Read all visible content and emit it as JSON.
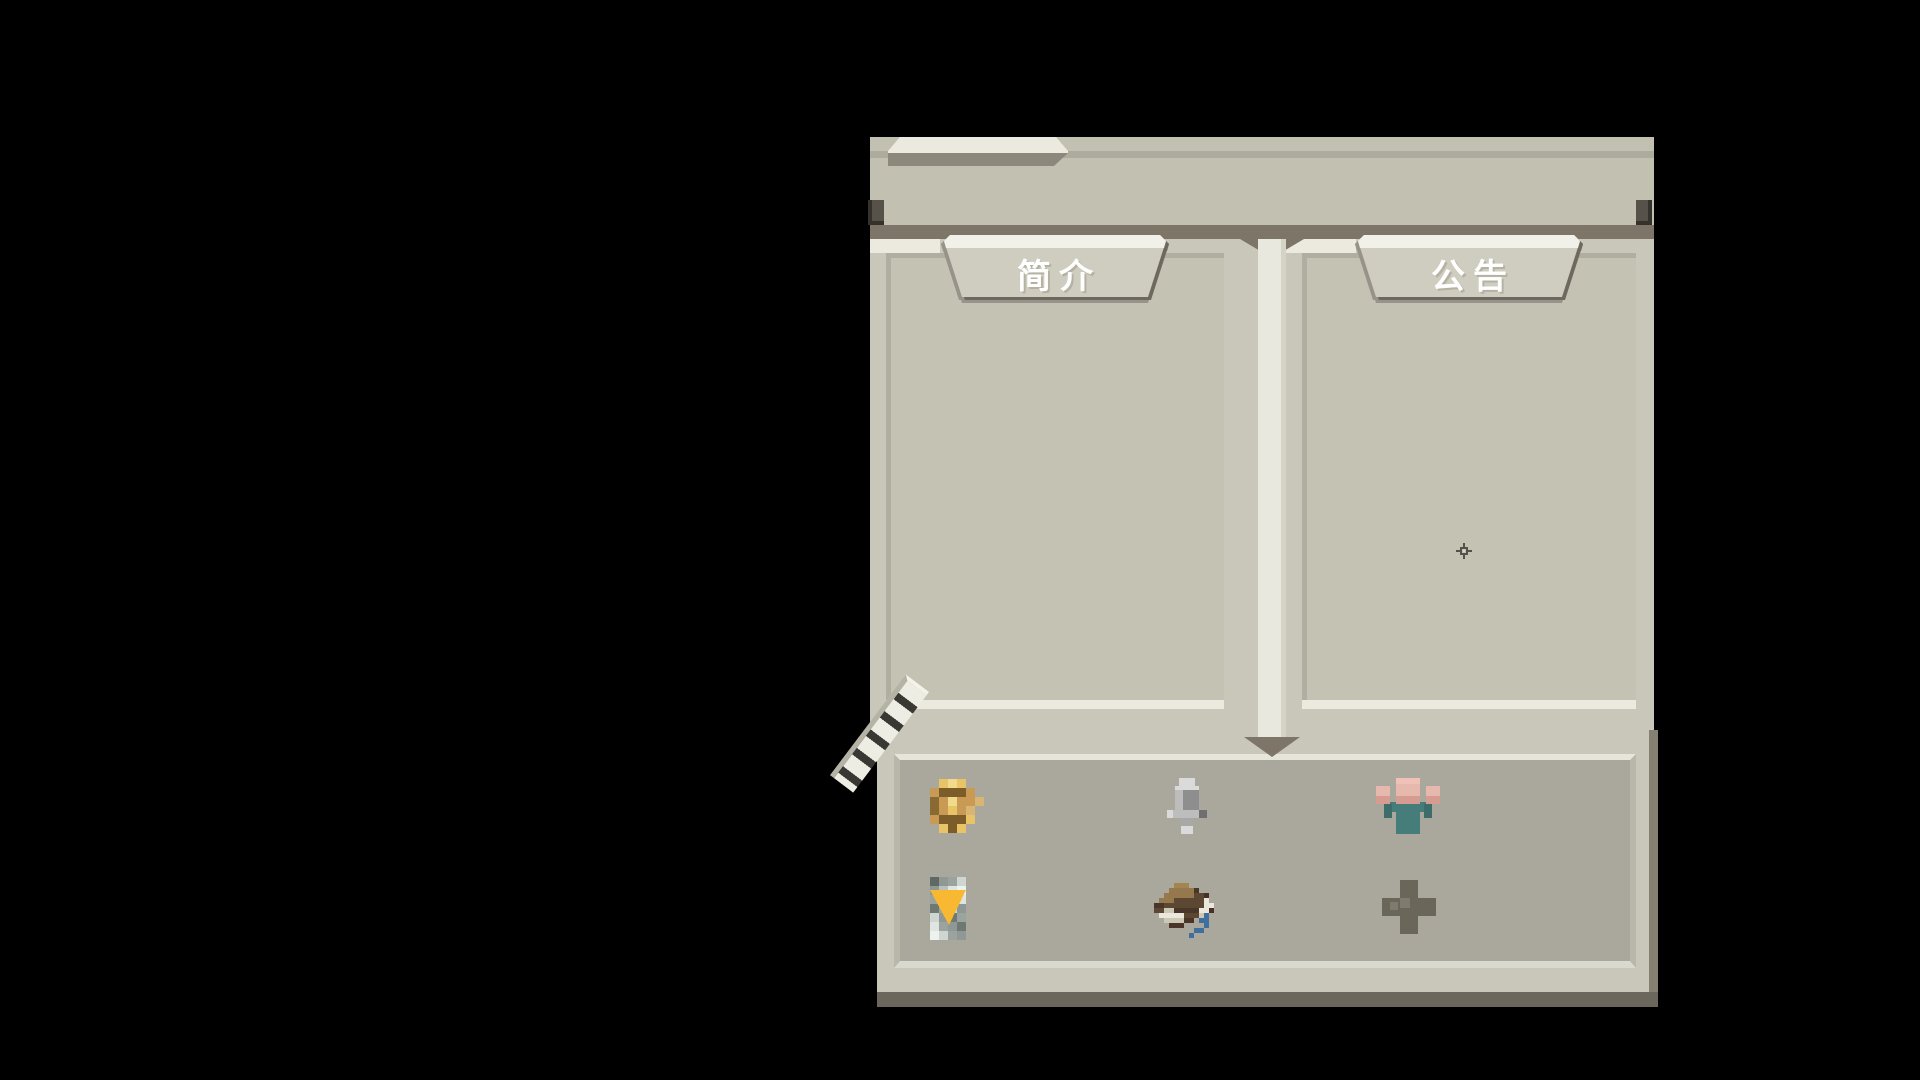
{
  "window": {
    "name": "game-info-window",
    "description": "pixel-art style info dialog with two reading panes and an icon tray"
  },
  "tabs": [
    {
      "id": "intro",
      "label": "简介"
    },
    {
      "id": "announcement",
      "label": "公告"
    }
  ],
  "panes": [
    {
      "name": "intro-pane",
      "content": ""
    },
    {
      "name": "announcement-pane",
      "content": ""
    }
  ],
  "bottom_tray": {
    "icons": [
      {
        "name": "coin-icon"
      },
      {
        "name": "microphone-icon"
      },
      {
        "name": "villager-icon"
      },
      {
        "name": "filter-triangle-icon"
      },
      {
        "name": "hat-icon"
      },
      {
        "name": "plus-icon"
      }
    ]
  },
  "decorations": {
    "sparkle": "four-point-sparkle",
    "ribbon": "striped-quill-ribbon"
  },
  "colors": {
    "background": "#000000",
    "banner": "#c2c0b1",
    "banner_line": "#adab9d",
    "dark_band": "#7d7567",
    "frame_light": "#c9c7b9",
    "pane_fill": "#c4c2b3",
    "highlight_white": "#eceadf",
    "tab_face": "#cfcdbf",
    "tab_shadow": "#6e695e",
    "tray_fill": "#aaa79d",
    "bottom_shadow": "#6b675d",
    "coin_gold": "#c89a54",
    "triangle_yellow": "#f9b832",
    "ribbon_blue": "#3e6f9f",
    "shirt_teal": "#467c79",
    "skin_pink": "#e7b8ad"
  }
}
